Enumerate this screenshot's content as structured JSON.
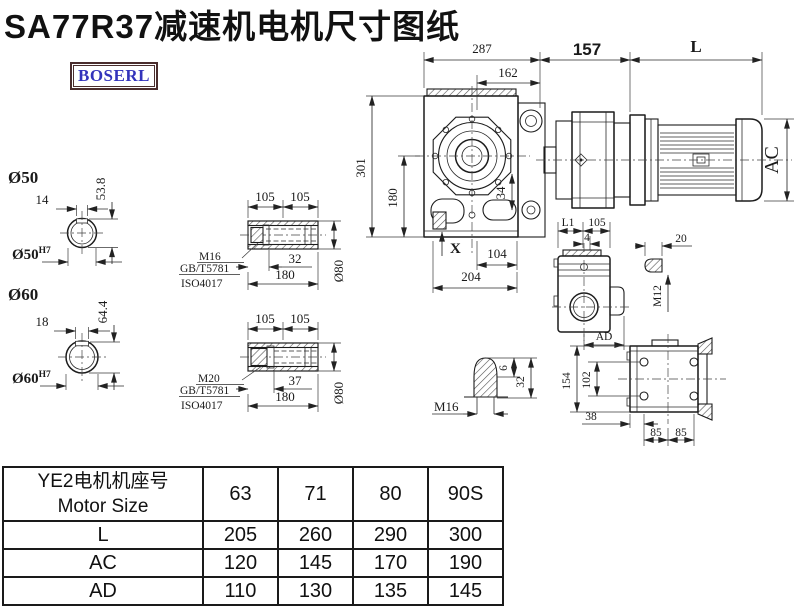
{
  "title": "SA77R37减速机电机尺寸图纸",
  "logo": {
    "text": "BOSERL"
  },
  "colors": {
    "line": "#1c1c1c",
    "dim": "#2a2a2a",
    "logo_border": "#4a2d2d",
    "logo_text": "#3333bb",
    "title": "#111111"
  },
  "main_view": {
    "dim_total_width": "287",
    "dim_flange_width": "162",
    "dim_adapter": "157",
    "dim_motor_length": "L",
    "dim_total_height": "301",
    "dim_center_height": "180",
    "dim_34": "34",
    "dim_x": "X",
    "dim_104": "104",
    "dim_204": "204",
    "dim_ac": "AC"
  },
  "section_d50": {
    "label": "Ø50",
    "key_width": "14",
    "corner_height": "53.8",
    "bore": "Ø50",
    "tolerance": "H7"
  },
  "section_d60": {
    "label": "Ø60",
    "key_width": "18",
    "corner_height": "64.4",
    "bore": "Ø60",
    "tolerance": "H7"
  },
  "hollow_shaft_m16": {
    "dim_left": "105",
    "dim_right": "105",
    "dim_bolt": "32",
    "dim_total": "180",
    "dim_dia": "Ø80",
    "thread": "M16",
    "standard": "GB/T5781",
    "iso": "ISO4017"
  },
  "hollow_shaft_m20": {
    "dim_left": "105",
    "dim_right": "105",
    "dim_bolt": "37",
    "dim_total": "180",
    "dim_dia": "Ø80",
    "thread": "M20",
    "standard": "GB/T5781",
    "iso": "ISO4017"
  },
  "side_view": {
    "dim_l1": "L1",
    "dim_105": "105",
    "dim_4": "4",
    "dim_ad": "AD",
    "key_detail": {
      "dim_20": "20",
      "thread": "M12"
    }
  },
  "vent_detail": {
    "thread": "M16",
    "dim_6": "6",
    "dim_32": "32"
  },
  "top_view": {
    "dim_154": "154",
    "dim_102": "102",
    "dim_38": "38",
    "dim_85a": "85",
    "dim_85b": "85"
  },
  "spec_table": {
    "header_cn": "YE2电机机座号",
    "header_en": "Motor Size",
    "motor_sizes": [
      "63",
      "71",
      "80",
      "90S"
    ],
    "rows": [
      {
        "label": "L",
        "values": [
          "205",
          "260",
          "290",
          "300"
        ]
      },
      {
        "label": "AC",
        "values": [
          "120",
          "145",
          "170",
          "190"
        ]
      },
      {
        "label": "AD",
        "values": [
          "110",
          "130",
          "135",
          "145"
        ]
      }
    ]
  }
}
